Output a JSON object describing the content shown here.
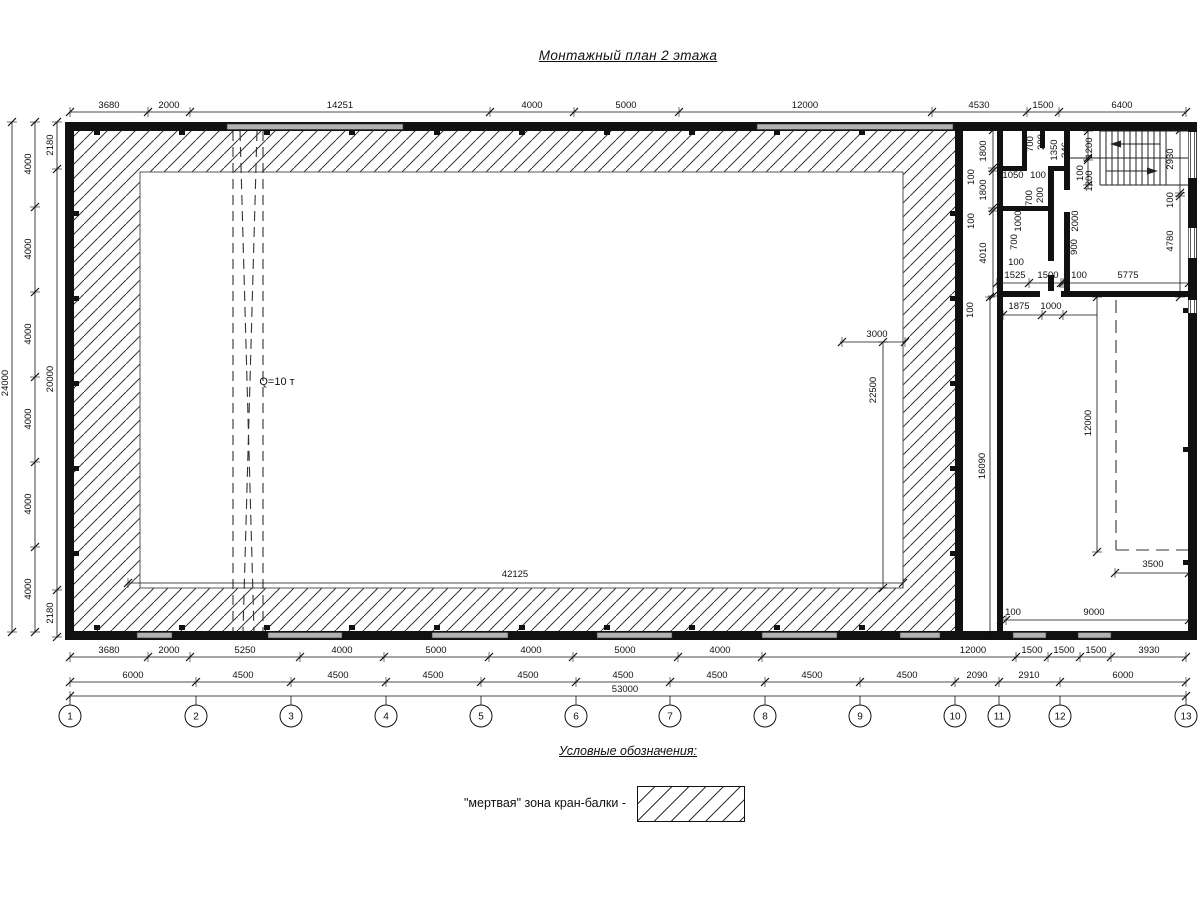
{
  "title": "Монтажный план 2 этажа",
  "legend": {
    "heading": "Условные обозначения:",
    "item_label": "\"мертвая\" зона кран-балки -"
  },
  "crane": {
    "capacity_label": "Q=10 т"
  },
  "colors": {
    "line": "#111111",
    "window": "#b3b3b3",
    "hatch": "#3a3a3a"
  },
  "axes": {
    "items": [
      {
        "n": "1",
        "x": 70
      },
      {
        "n": "2",
        "x": 196
      },
      {
        "n": "3",
        "x": 291
      },
      {
        "n": "4",
        "x": 386
      },
      {
        "n": "5",
        "x": 481
      },
      {
        "n": "6",
        "x": 576
      },
      {
        "n": "7",
        "x": 670
      },
      {
        "n": "8",
        "x": 765
      },
      {
        "n": "9",
        "x": 860
      },
      {
        "n": "10",
        "x": 955
      },
      {
        "n": "11",
        "x": 999
      },
      {
        "n": "12",
        "x": 1060
      },
      {
        "n": "13",
        "x": 1186
      }
    ]
  },
  "dimensions": {
    "h_rows": [
      {
        "name": "top",
        "y": 112,
        "x1": 70,
        "x2": 1186,
        "ticks": [
          70,
          148,
          190,
          490,
          574,
          679,
          932,
          1027,
          1059,
          1186
        ],
        "labels": [
          {
            "t": "3680",
            "x": 109
          },
          {
            "t": "2000",
            "x": 169
          },
          {
            "t": "14251",
            "x": 340
          },
          {
            "t": "4000",
            "x": 532
          },
          {
            "t": "5000",
            "x": 626
          },
          {
            "t": "12000",
            "x": 805
          },
          {
            "t": "4530",
            "x": 979
          },
          {
            "t": "1500",
            "x": 1043
          },
          {
            "t": "6400",
            "x": 1122
          }
        ]
      },
      {
        "name": "bottom-1",
        "y": 657,
        "x1": 70,
        "x2": 1186,
        "ticks": [
          70,
          148,
          190,
          300,
          384,
          489,
          573,
          678,
          762,
          1016,
          1048,
          1080,
          1111,
          1186
        ],
        "labels": [
          {
            "t": "3680",
            "x": 109
          },
          {
            "t": "2000",
            "x": 169
          },
          {
            "t": "5250",
            "x": 245
          },
          {
            "t": "4000",
            "x": 342
          },
          {
            "t": "5000",
            "x": 436
          },
          {
            "t": "4000",
            "x": 531
          },
          {
            "t": "5000",
            "x": 625
          },
          {
            "t": "4000",
            "x": 720
          },
          {
            "t": "12000",
            "x": 973
          },
          {
            "t": "1500",
            "x": 1032
          },
          {
            "t": "1500",
            "x": 1064
          },
          {
            "t": "1500",
            "x": 1096
          },
          {
            "t": "3930",
            "x": 1149
          }
        ]
      },
      {
        "name": "bottom-2",
        "y": 682,
        "x1": 70,
        "x2": 1186,
        "ticks": [
          70,
          196,
          291,
          386,
          481,
          576,
          670,
          765,
          860,
          955,
          999,
          1060,
          1186
        ],
        "labels": [
          {
            "t": "6000",
            "x": 133
          },
          {
            "t": "4500",
            "x": 243
          },
          {
            "t": "4500",
            "x": 338
          },
          {
            "t": "4500",
            "x": 433
          },
          {
            "t": "4500",
            "x": 528
          },
          {
            "t": "4500",
            "x": 623
          },
          {
            "t": "4500",
            "x": 717
          },
          {
            "t": "4500",
            "x": 812
          },
          {
            "t": "4500",
            "x": 907
          },
          {
            "t": "2090",
            "x": 977
          },
          {
            "t": "2910",
            "x": 1029
          },
          {
            "t": "6000",
            "x": 1123
          }
        ]
      },
      {
        "name": "bottom-total",
        "y": 696,
        "x1": 70,
        "x2": 1186,
        "ticks": [
          70,
          1186
        ],
        "labels": [
          {
            "t": "53000",
            "x": 625
          }
        ]
      },
      {
        "name": "room-door",
        "y": 283,
        "x1": 997,
        "x2": 1189,
        "ticks": [
          997,
          1029,
          1061,
          1063,
          1189
        ],
        "labels": []
      },
      {
        "name": "room-1875",
        "y": 315,
        "x1": 1003,
        "x2": 1097,
        "ticks": [
          1003,
          1042,
          1063
        ],
        "labels": []
      },
      {
        "name": "dead-zone-3500",
        "y": 573,
        "x1": 1115,
        "x2": 1189,
        "ticks": [
          1115,
          1189
        ],
        "labels": []
      },
      {
        "name": "room-9000",
        "y": 620,
        "x1": 1001,
        "x2": 1189,
        "ticks": [
          1001,
          1006,
          1189
        ],
        "labels": []
      },
      {
        "name": "hall-3000",
        "y": 342,
        "x1": 840,
        "x2": 905,
        "ticks": [
          842,
          905
        ],
        "labels": []
      },
      {
        "name": "hall-42125",
        "y": 583,
        "x1": 128,
        "x2": 903,
        "ticks": [
          128,
          903
        ],
        "labels": []
      }
    ],
    "v_rows": [
      {
        "name": "left-outer",
        "x": 12,
        "y1": 122,
        "y2": 632,
        "ticks": [
          122,
          632
        ],
        "labels": [
          {
            "t": "24000",
            "y": 383
          }
        ]
      },
      {
        "name": "left-mid",
        "x": 35,
        "y1": 122,
        "y2": 632,
        "ticks": [
          122,
          207,
          292,
          377,
          462,
          547,
          632
        ],
        "labels": [
          {
            "t": "4000",
            "y": 164
          },
          {
            "t": "4000",
            "y": 249
          },
          {
            "t": "4000",
            "y": 334
          },
          {
            "t": "4000",
            "y": 419
          },
          {
            "t": "4000",
            "y": 504
          },
          {
            "t": "4000",
            "y": 589
          }
        ]
      },
      {
        "name": "left-inner",
        "x": 57,
        "y1": 122,
        "y2": 637,
        "ticks": [
          122,
          169,
          590,
          637
        ],
        "labels": [
          {
            "t": "2180",
            "y": 145
          },
          {
            "t": "20000",
            "y": 379
          },
          {
            "t": "2180",
            "y": 613
          }
        ]
      },
      {
        "name": "corridor-dims",
        "x": 993,
        "y1": 130,
        "y2": 296,
        "ticks": [
          130,
          168,
          171,
          208,
          211,
          296
        ],
        "labels": []
      },
      {
        "name": "stair-right-dims",
        "x": 1180,
        "y1": 128,
        "y2": 297,
        "ticks": [
          130,
          193,
          196,
          297
        ],
        "labels": []
      },
      {
        "name": "stair-flight-dims",
        "x": 1088,
        "y1": 128,
        "y2": 188,
        "ticks": [
          131,
          158,
          160,
          185
        ],
        "labels": []
      },
      {
        "name": "room-12000-dim",
        "x": 1097,
        "y1": 297,
        "y2": 552,
        "ticks": [
          297,
          552
        ],
        "labels": []
      },
      {
        "name": "room-16090-dim",
        "x": 990,
        "y1": 297,
        "y2": 635,
        "ticks": [
          297,
          635
        ],
        "labels": []
      },
      {
        "name": "hall-22500-dim",
        "x": 883,
        "y1": 342,
        "y2": 588,
        "ticks": [
          342,
          588
        ],
        "labels": []
      }
    ],
    "free": [
      {
        "t": "1800",
        "x": 986,
        "y": 151,
        "r": 1
      },
      {
        "t": "100",
        "x": 974,
        "y": 177,
        "r": 1
      },
      {
        "t": "1800",
        "x": 986,
        "y": 190,
        "r": 1
      },
      {
        "t": "100",
        "x": 974,
        "y": 221,
        "r": 1
      },
      {
        "t": "4010",
        "x": 986,
        "y": 253,
        "r": 1
      },
      {
        "t": "700",
        "x": 1033,
        "y": 144,
        "r": 1
      },
      {
        "t": "200",
        "x": 1044,
        "y": 142,
        "r": 1
      },
      {
        "t": "1350",
        "x": 1057,
        "y": 150,
        "r": 1
      },
      {
        "t": "246",
        "x": 1068,
        "y": 150,
        "r": 1
      },
      {
        "t": "1050",
        "x": 1013,
        "y": 178,
        "r": 0
      },
      {
        "t": "100",
        "x": 1038,
        "y": 178,
        "r": 0
      },
      {
        "t": "700",
        "x": 1032,
        "y": 198,
        "r": 1
      },
      {
        "t": "200",
        "x": 1043,
        "y": 195,
        "r": 1
      },
      {
        "t": "1000",
        "x": 1021,
        "y": 221,
        "r": 1
      },
      {
        "t": "700",
        "x": 1017,
        "y": 242,
        "r": 1
      },
      {
        "t": "100",
        "x": 1016,
        "y": 265,
        "r": 0
      },
      {
        "t": "1525",
        "x": 1015,
        "y": 278,
        "r": 0
      },
      {
        "t": "1500",
        "x": 1048,
        "y": 278,
        "r": 0
      },
      {
        "t": "100",
        "x": 1079,
        "y": 278,
        "r": 0
      },
      {
        "t": "5775",
        "x": 1128,
        "y": 278,
        "r": 0
      },
      {
        "t": "1200",
        "x": 1092,
        "y": 148,
        "r": 1
      },
      {
        "t": "100",
        "x": 1083,
        "y": 173,
        "r": 1
      },
      {
        "t": "1200",
        "x": 1092,
        "y": 181,
        "r": 1
      },
      {
        "t": "2930",
        "x": 1173,
        "y": 159,
        "r": 1
      },
      {
        "t": "100",
        "x": 1173,
        "y": 200,
        "r": 1
      },
      {
        "t": "4780",
        "x": 1173,
        "y": 241,
        "r": 1
      },
      {
        "t": "2000",
        "x": 1078,
        "y": 221,
        "r": 1
      },
      {
        "t": "900",
        "x": 1077,
        "y": 247,
        "r": 1
      },
      {
        "t": "100",
        "x": 973,
        "y": 310,
        "r": 1
      },
      {
        "t": "1875",
        "x": 1019,
        "y": 309,
        "r": 0
      },
      {
        "t": "1000",
        "x": 1051,
        "y": 309,
        "r": 0
      },
      {
        "t": "12000",
        "x": 1091,
        "y": 423,
        "r": 1
      },
      {
        "t": "16090",
        "x": 985,
        "y": 466,
        "r": 1
      },
      {
        "t": "3500",
        "x": 1153,
        "y": 567,
        "r": 0
      },
      {
        "t": "100",
        "x": 1013,
        "y": 615,
        "r": 0
      },
      {
        "t": "9000",
        "x": 1094,
        "y": 615,
        "r": 0
      },
      {
        "t": "3000",
        "x": 877,
        "y": 337,
        "r": 0
      },
      {
        "t": "22500",
        "x": 876,
        "y": 390,
        "r": 1
      },
      {
        "t": "42125",
        "x": 515,
        "y": 577,
        "r": 0
      },
      {
        "t": "Q=10 т",
        "x": 277,
        "y": 385,
        "r": 0,
        "fs": 11
      }
    ]
  }
}
